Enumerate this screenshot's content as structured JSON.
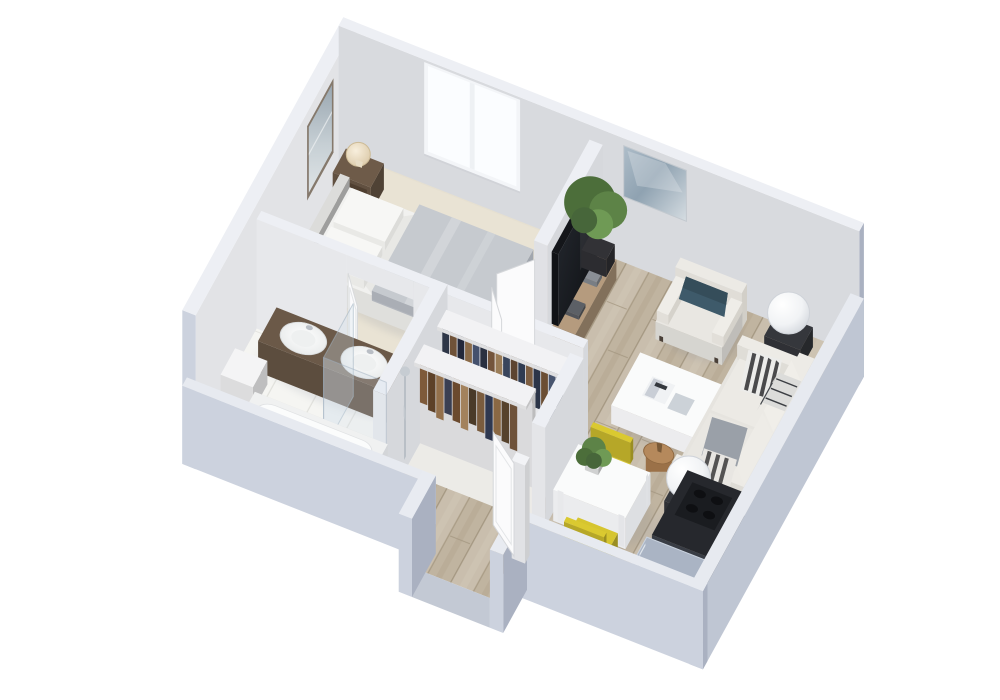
{
  "meta": {
    "title": "3D isometric cutaway floor plan rendering of a one-bedroom apartment",
    "background": "#ffffff"
  },
  "palette": {
    "wall_top": "#edeff4",
    "wall_interior_nw": "#e2e3e6",
    "wall_interior_ne": "#d8dade",
    "wall_partition": "#e9eaee",
    "wall_exterior_light": "#ccd2de",
    "wall_exterior_dark": "#aab1c1",
    "floor_carpet": "#e9e3d4",
    "floor_wood": "#c9bead",
    "floor_tile": "#f5f5f2",
    "floor_closet": "#ecebe7",
    "window_glass": "#fbfdff",
    "bed_sheet": "#f1f1ef",
    "duvet_gray": "#c6cacf",
    "nightstand_wood": "#6e5b49",
    "lamp_warm": "#f0e5cf",
    "tv_black": "#15181d",
    "console_wood": "#b59b7e",
    "plant_green": "#55793f",
    "sofa_white": "#e6e4df",
    "armchair_white": "#e9e7e2",
    "pillow_teal": "#3e5a6a",
    "pillow_gray": "#9aa0a8",
    "coffee_table_white": "#fafbfb",
    "stool_wood": "#b5895c",
    "dining_table_white": "#fafbfb",
    "chair_yellow": "#d6c52f",
    "counter_black": "#26282d",
    "appliance_gray": "#aab4c4",
    "vanity_wood": "#6b5948",
    "tub_white": "#f0f1f1",
    "clothes_navy": "#2e3647",
    "clothes_brown": "#7e5a3a",
    "door_white": "#fbfbfc",
    "shadow": "#7d8494"
  },
  "rooms": [
    {
      "id": "bedroom",
      "name": "bedroom",
      "floor": "carpet"
    },
    {
      "id": "living-room",
      "name": "living room",
      "floor": "wood"
    },
    {
      "id": "bathroom",
      "name": "bathroom",
      "floor": "tile"
    },
    {
      "id": "walk-in-closet",
      "name": "walk-in closet",
      "floor": "closet"
    },
    {
      "id": "dining-area",
      "name": "dining area",
      "floor": "wood"
    },
    {
      "id": "kitchen",
      "name": "kitchen",
      "floor": "wood"
    },
    {
      "id": "entry-hall",
      "name": "entry hall",
      "floor": "wood"
    }
  ],
  "objects": {
    "nw-wall": "exterior wall north-west",
    "ne-wall": "exterior wall north-east with window",
    "se-wall": "low exterior wall south-east",
    "sw-wall": "low exterior wall south-west with entry opening",
    "window": "double window",
    "art-bedroom": "framed landscape picture",
    "art-living": "abstract wall art",
    "bed": "double bed with gray duvet",
    "headboard": "bed headboard",
    "nightstand-a": "nightstand with table lamp",
    "nightstand-b": "nightstand with table lamp",
    "bench-teal": "teal bedroom cushion",
    "tv-partition": "tv partition wall",
    "tv": "flat screen tv",
    "media-console": "media console",
    "plant-tall": "tall potted plant",
    "bedroom-doors": "double doors bedroom to living room",
    "bathroom-door": "bathroom door",
    "vanity": "bathroom vanity with twin round sinks",
    "bath-shelf": "wall hung bathroom cabinet",
    "bathtub": "bathtub",
    "shower": "shower with glass screen",
    "closet-rack-upper": "closet rack with hanging clothes",
    "closet-rack-lower": "closet rack with hanging clothes",
    "armchair": "white armchair with teal pillow",
    "sofa": "white sofa with striped pillows and plaid throw",
    "coffee-table": "white coffee table with magazines",
    "floor-lamp-a": "dome floor lamp",
    "floor-lamp-b": "dome floor lamp",
    "stool": "round wooden side stool",
    "dining-table": "white dining table with plant",
    "dining-chair-a": "yellow dining chair",
    "dining-chair-b": "yellow dining chair",
    "kitchen-counter": "dark kitchen counter with cooktop and oven",
    "appliance": "gray kitchen appliance",
    "entry-door": "open entry door",
    "vestibule": "entry vestibule"
  }
}
